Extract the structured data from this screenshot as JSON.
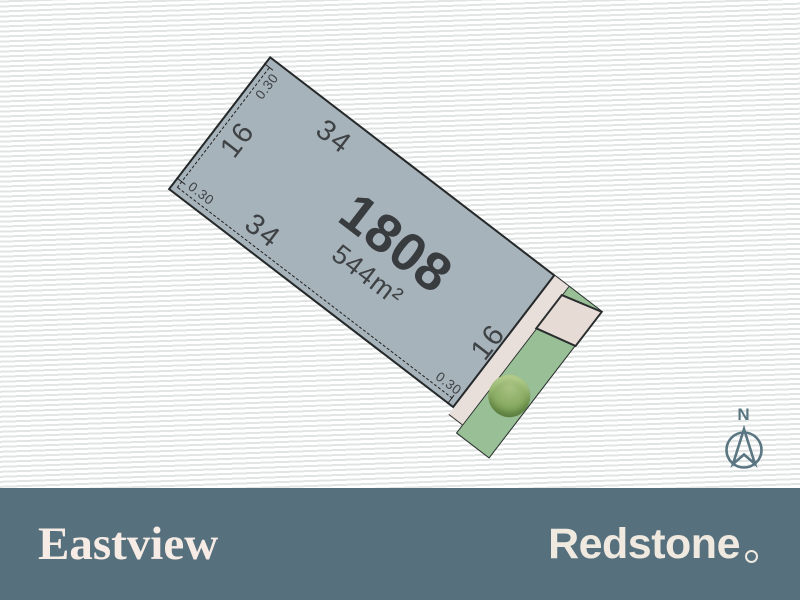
{
  "plan": {
    "lot": {
      "number": "1808",
      "area": "544m²",
      "dim_top": "34",
      "dim_left": "16",
      "dim_bottom": "34",
      "dim_frontage": "16",
      "offset_top": "0.30",
      "offset_left": "0.30",
      "offset_bottom": "0.30"
    },
    "compass": {
      "label": "N"
    }
  },
  "footer": {
    "estate_name": "Eastview",
    "developer_name": "Redstone"
  },
  "colors": {
    "lot_fill": "#a7b3ba",
    "lot_border": "#26292a",
    "footpath_cream": "#e9dfda",
    "reserve_green": "#98bf96",
    "tree_green": "#7da258",
    "footer_bar": "#56707d",
    "logo_cream": "#f7ece5",
    "compass_slate": "#5a7682",
    "background_stripe": "#e0e5e3"
  }
}
